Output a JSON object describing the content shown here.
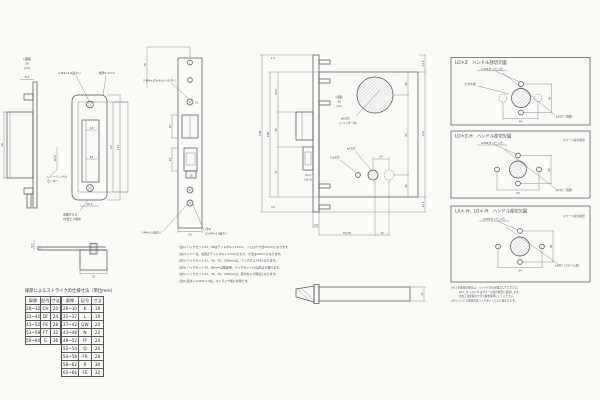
{
  "page": {
    "bg": "#fafaf7",
    "ink": "#4a4a4a"
  },
  "strike_side": {
    "chamfer": "C面取",
    "dim_30": "30",
    "dim_13": "(13)",
    "dim_85": "8.5",
    "dim_70": "70",
    "dim_365": "36.5",
    "note1": "レバーハンドル",
    "note2": "センター"
  },
  "strike_front": {
    "lead_screws": "2-M4×1.4皿ネジ",
    "lead_thickness": "板厚1.2mm",
    "dim_14": "14",
    "dim_16": "16",
    "dim_83": "83",
    "dim_113": "113",
    "dim_165": "16.5",
    "note1": "扉面ぞろえ",
    "note2": "2P皿ビス留め"
  },
  "faceplate": {
    "dim_16_top": "16",
    "lead_screws": "2-M4×(76.4)ナベ小ネジ",
    "dim_10": "10",
    "dim_26a": "26",
    "dim_26b": "26",
    "dim_16b": "16",
    "dim_25": "25",
    "note_left": "2-M4×1.4皿ネジ",
    "note_right1": "(注6)",
    "note_right2": "(2)-M4×1.4皿ネジ"
  },
  "main_case": {
    "stack1": "C面取",
    "stack2": "30",
    "stack3": "(13)",
    "dead1": "21.5",
    "dead2": "(36.5)",
    "hole_big1": "φ50穴",
    "hole_big2": "(シリンダー用)",
    "hole_15": "φ15穴",
    "hole_5": "2-φ5穴",
    "dim_54": "54",
    "l_178": "178",
    "l_150": "150",
    "l_505": "50.5",
    "l_38": "38",
    "l_51": "51",
    "l_15": "1.5",
    "l_45": "4.5",
    "r_48": "48",
    "r_80": "80",
    "r_45": "45",
    "r_215": "21.5",
    "r_174": "174",
    "r_225": "22.5",
    "b_45": "4.5",
    "b_76": "76(79)",
    "b_13": "13"
  },
  "latch_side": {
    "dim_21": "21"
  },
  "section": {
    "dim_85": "8.5",
    "dim_24": "24"
  },
  "panels": [
    {
      "title": "LO＊Z　ハンドル部切欠図",
      "sub": "",
      "screws": "2-M4タッピン穴",
      "scribe": "ケガキ線",
      "dim_w": "64",
      "dim_h": "38",
      "note": "φ15穴（貫通）"
    },
    {
      "title": "LO＊Z-H　ハンドル部切欠図",
      "sub": "（スチール扉の場合）",
      "screws": "4-M4タッピン穴",
      "scribe": "",
      "dim_w": "64",
      "dim_h": "38",
      "note": "φ15穴（貫通）"
    },
    {
      "title": "LA＊-H、LO＊-H　ハンドル部切欠図",
      "sub": "（スチール扉の場合）",
      "screws": "4-M4タッピン穴",
      "scribe": "",
      "dim_w": "64",
      "dim_h": "38",
      "note": "φ50穴（スチール扉）"
    }
  ],
  "panel_notes": [
    "(※1) 木製扉の場合は、ハンドル穴のみ加工してください。",
    "　　　LO＊-H、LA＊-H はスチール扉の場合に使用します。",
    "　　　穴加工は扉面のケガキ線を基準にしてください。",
    "(※2) ハンドル部切欠はバックセットにより異なります。"
  ],
  "notes": [
    "(注1) バックセット31、38はデッドボルト17mm、トロヨケ寸法25mmとなります。",
    "(注2) レバーは、位置がデッドボルト17mmとなり、寸法は19mmとなります。",
    "(注3) バックセット31、38、76、100mmは、フックボルト付となります。",
    "(注4) バックセット76、86mmは框扉用、バックセット(2)は右より選べます。",
    "(注5) バックセット31、38、76、100mmは、取付ねじが別途となります。",
    "(注6) 皿ネジ2-M4×1.4は、ストライク用と共用です。"
  ],
  "table": {
    "title": "扉厚によるストライクの仕様寸法（単位mm）",
    "group_a": [
      [
        "扉厚",
        "記号",
        "寸法"
      ],
      [
        "28~32",
        "CH",
        "20"
      ],
      [
        "33~42",
        "DF",
        "24"
      ],
      [
        "43~52",
        "FK",
        "28"
      ],
      [
        "53~58",
        "FT",
        "32"
      ],
      [
        "59~64",
        "G",
        "36"
      ]
    ],
    "group_b": [
      [
        "扉厚",
        "記号",
        "寸法"
      ],
      [
        "26~30",
        "K",
        "18"
      ],
      [
        "31~37",
        "L",
        "19"
      ],
      [
        "37~42",
        "GW",
        "20"
      ],
      [
        "43~48",
        "N",
        "22"
      ],
      [
        "48~52",
        "FF",
        "24"
      ],
      [
        "52~54",
        "Q",
        "26"
      ],
      [
        "54~58",
        "FR",
        "28"
      ],
      [
        "58~62",
        "R",
        "30"
      ],
      [
        "62~66",
        "FE",
        "32"
      ]
    ]
  }
}
